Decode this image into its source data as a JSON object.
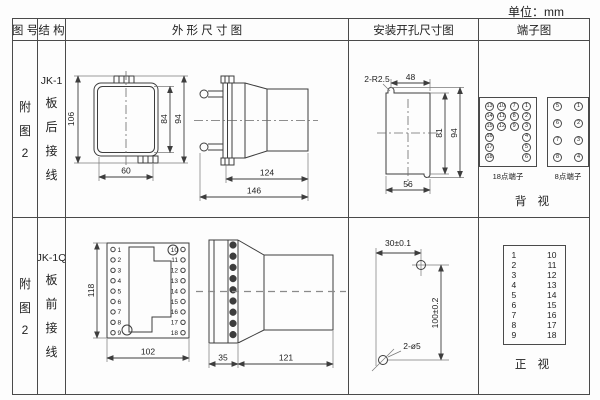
{
  "unit_label": "单位：mm",
  "headers": {
    "figure_no": "图 号",
    "structure": "结 构",
    "outline": "外 形 尺 寸 图",
    "mounting": "安装开孔尺寸图",
    "terminal": "端子图"
  },
  "rows": [
    {
      "figure_no_chars": [
        "附",
        "图",
        "2"
      ],
      "structure_chars": [
        "JK-1",
        "板",
        "后",
        "接",
        "线"
      ],
      "outline": {
        "front_height": "106",
        "inner_height": "84",
        "outer_height": "94",
        "front_width": "60",
        "body_length": "124",
        "total_length": "146"
      },
      "mounting": {
        "slot_label": "2-R2.5",
        "top_width": "48",
        "inner_height": "81",
        "outer_height": "94",
        "bottom_width": "56"
      },
      "terminal": {
        "block18_label": "18点端子",
        "block8_label": "8点端子",
        "view_label": "背 视",
        "block18_rows": [
          [
            "13",
            "10",
            "7",
            "1"
          ],
          [
            "14",
            "11",
            "8",
            "2"
          ],
          [
            "15",
            "12",
            "9",
            "3"
          ],
          [
            "16",
            "",
            "",
            "4"
          ],
          [
            "17",
            "",
            "",
            "5"
          ],
          [
            "18",
            "",
            "",
            "6"
          ]
        ],
        "block8_rows": [
          [
            "5",
            "1"
          ],
          [
            "6",
            "2"
          ],
          [
            "7",
            "3"
          ],
          [
            "8",
            "4"
          ]
        ]
      }
    },
    {
      "figure_no_chars": [
        "附",
        "图",
        "2"
      ],
      "structure_chars": [
        "JK-1Q",
        "板",
        "前",
        "接",
        "线"
      ],
      "outline": {
        "front_height": "118",
        "front_width": "102",
        "flange_depth": "35",
        "body_length": "121",
        "left_pins": [
          "1",
          "2",
          "3",
          "4",
          "5",
          "6",
          "7",
          "8",
          "9"
        ],
        "right_pins": [
          "10",
          "11",
          "12",
          "13",
          "14",
          "15",
          "16",
          "17",
          "18"
        ]
      },
      "mounting": {
        "h_dim": "30±0.1",
        "v_dim": "100±0.2",
        "holes_label": "2-ø5"
      },
      "terminal": {
        "view_label": "正 视",
        "left_pins": [
          "1",
          "2",
          "3",
          "4",
          "5",
          "6",
          "7",
          "8",
          "9"
        ],
        "right_pins": [
          "10",
          "11",
          "12",
          "13",
          "14",
          "15",
          "16",
          "17",
          "18"
        ]
      }
    }
  ]
}
